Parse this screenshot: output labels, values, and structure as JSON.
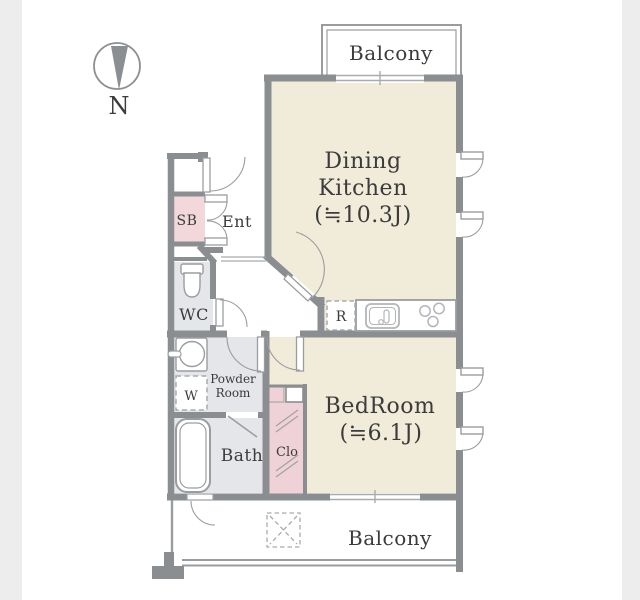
{
  "plan": {
    "compass_label": "N",
    "balcony_top_label": "Balcony",
    "balcony_bottom_label": "Balcony",
    "dining_kitchen": {
      "line1": "Dining",
      "line2": "Kitchen",
      "size": "(≒10.3J)"
    },
    "bedroom": {
      "line1": "BedRoom",
      "size": "(≒6.1J)"
    },
    "entrance_label": "Ent",
    "shoe_box_label": "SB",
    "wc_label": "WC",
    "powder_room": {
      "line1": "Powder",
      "line2": "Room"
    },
    "washer_label": "W",
    "bath_label": "Bath",
    "closet_label": "Clo",
    "refrigerator_label": "R"
  },
  "colors": {
    "wall": "#8b8e91",
    "thin_line": "#9a9da0",
    "floor_beige": "#f1ebd9",
    "floor_gray": "#e4e6e9",
    "floor_pink": "#f3d8db",
    "closet_pink": "#eed2d8",
    "text": "#3b3b3b",
    "page_margin": "#ededed"
  }
}
